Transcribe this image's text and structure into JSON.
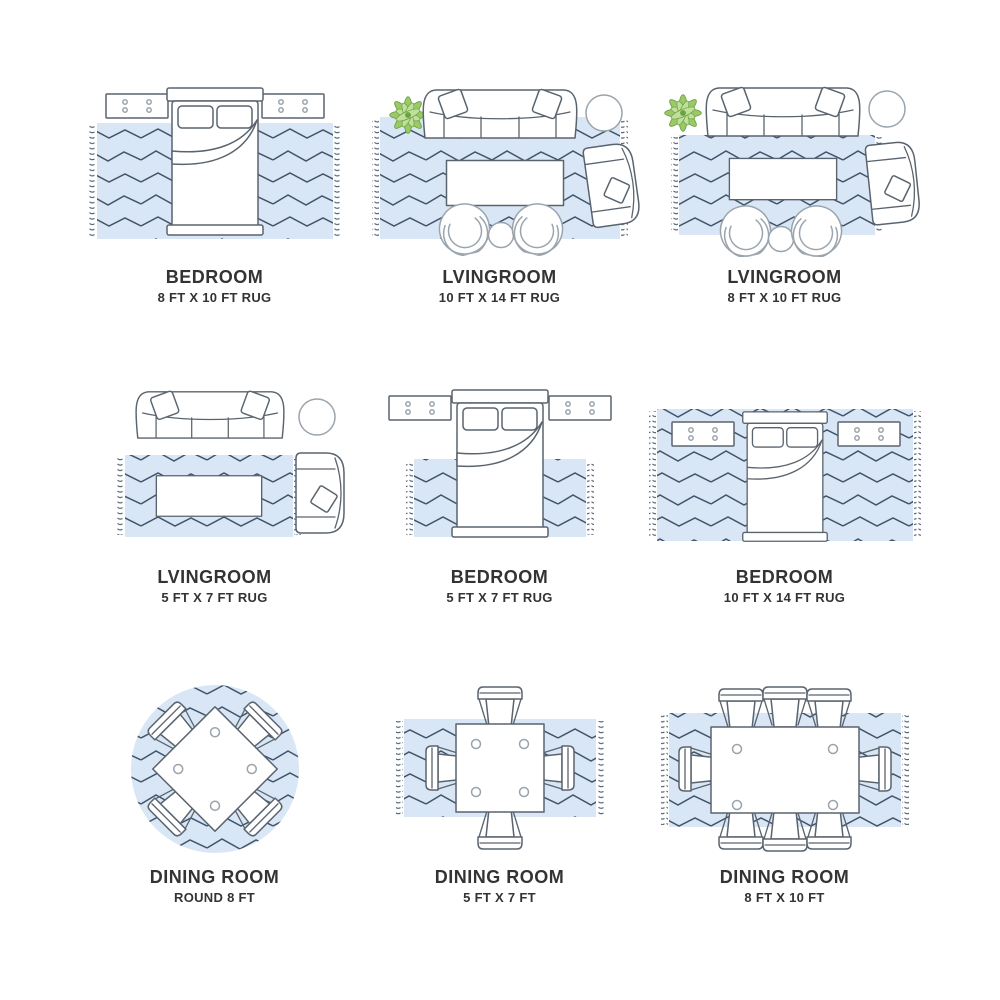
{
  "colors": {
    "background": "#ffffff",
    "rug": "#d9e6f5",
    "zigzag": "#40546a",
    "fringe": "#49596a",
    "outline_dark": "#5a646e",
    "outline_light": "#9aa4ad",
    "plant_fill": "#9cc968",
    "plant_stroke": "#6ba244",
    "text": "#333333"
  },
  "cells": [
    {
      "room": "BEDROOM",
      "size": "8 FT X 10 FT RUG",
      "illustration": "bed-two-nightstands-on-8x10-rug"
    },
    {
      "room": "LVINGROOM",
      "size": "10 FT X 14 FT RUG",
      "illustration": "sofa-armchair-two-chairs-coffee-table-plant-on-10x14-rug"
    },
    {
      "room": "LVINGROOM",
      "size": "8 FT X 10 FT RUG",
      "illustration": "sofa-armchair-two-chairs-coffee-table-plant-on-8x10-rug"
    },
    {
      "room": "LVINGROOM",
      "size": "5 FT X 7 FT RUG",
      "illustration": "sofa-armchair-coffee-table-on-5x7-rug"
    },
    {
      "room": "BEDROOM",
      "size": "5 FT X 7 FT RUG",
      "illustration": "bed-foot-on-5x7-rug"
    },
    {
      "room": "BEDROOM",
      "size": "10 FT X 14 FT RUG",
      "illustration": "bed-and-nightstands-on-10x14-rug"
    },
    {
      "room": "DINING ROOM",
      "size": "ROUND 8 FT",
      "illustration": "square-table-four-chairs-on-round-rug"
    },
    {
      "room": "DINING ROOM",
      "size": "5 FT X 7 FT",
      "illustration": "square-table-four-chairs-on-5x7-rug"
    },
    {
      "room": "DINING ROOM",
      "size": "8 FT X 10 FT",
      "illustration": "rectangular-table-eight-chairs-on-8x10-rug"
    }
  ]
}
